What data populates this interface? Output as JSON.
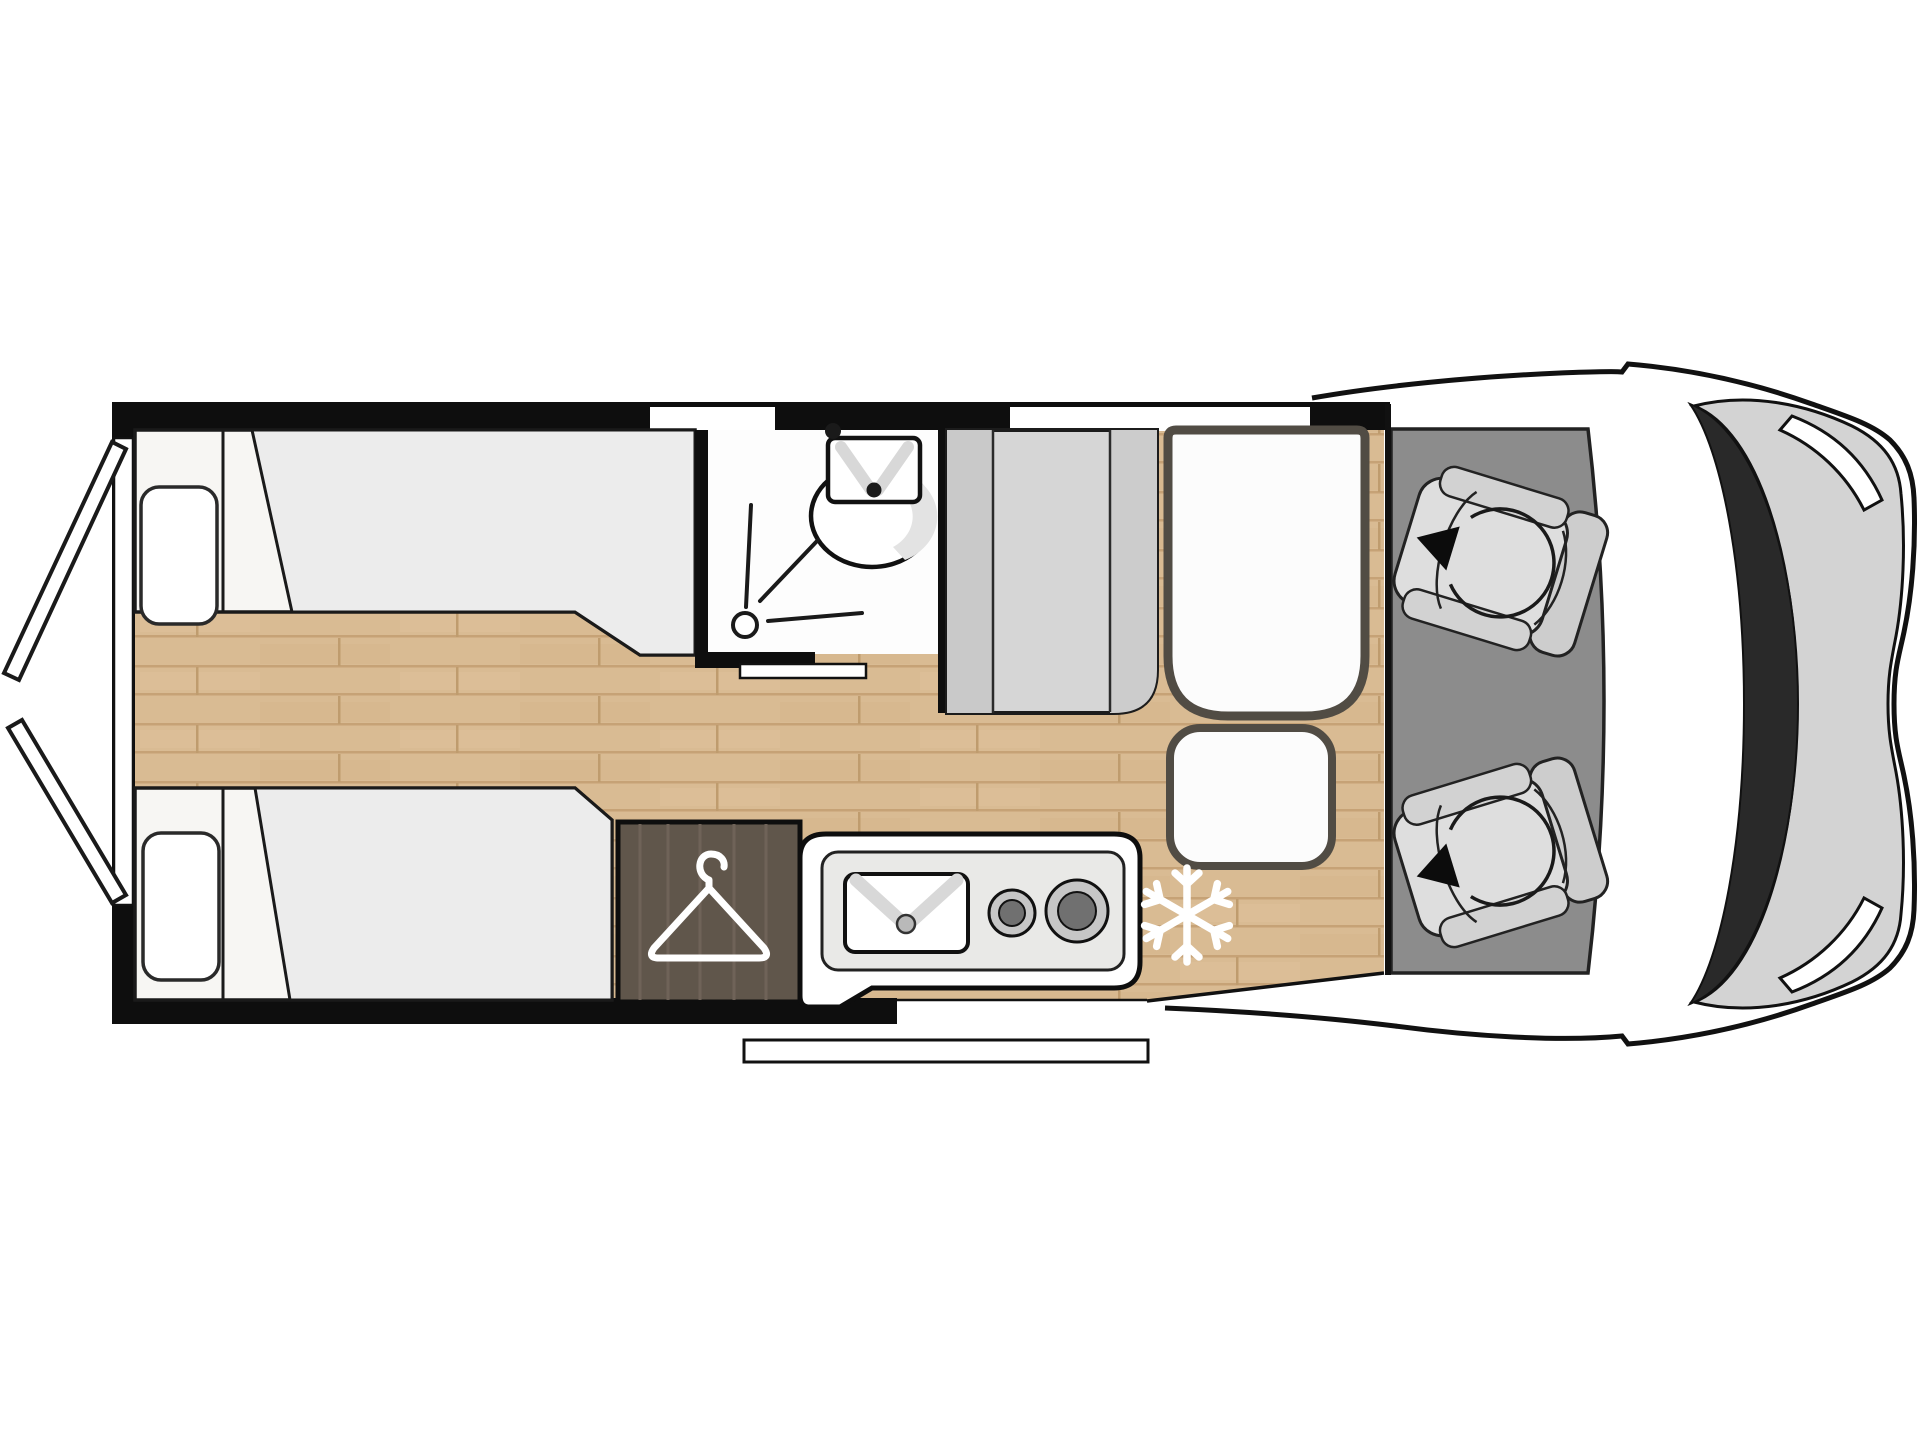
{
  "page": {
    "description": "Top-down floor plan of a campervan / motorhome with rear twin single beds, wardrobe, bathroom, kitchen and swivel cab seats",
    "view": "top-down floor plan",
    "visible_text": []
  },
  "diagram": {
    "type": "floor-plan",
    "vehicle": "campervan",
    "features": {
      "rear_doors": {
        "label": "Rear doors shown open",
        "count": 2
      },
      "bed_top": {
        "label": "Rear single bed with pillow (left side)"
      },
      "bed_bottom": {
        "label": "Rear single bed with pillow (right side)"
      },
      "corridor": {
        "label": "Central wood-floor corridor between beds"
      },
      "wardrobe": {
        "label": "Wardrobe",
        "icon": "hanger-icon"
      },
      "bathroom": {
        "label": "Bathroom with shower and washbasin",
        "icons": [
          "shower-drain-icon",
          "washbasin-icon"
        ]
      },
      "bathroom_door": {
        "label": "Sliding bathroom door"
      },
      "kitchen": {
        "label": "Kitchen unit with sink and two-burner hob",
        "burners": 2
      },
      "fridge": {
        "label": "Refrigerator position",
        "icon": "snowflake-icon"
      },
      "cabinet": {
        "label": "Tall cabinet / sideboard unit"
      },
      "dinette_bench": {
        "label": "Dinette bench seat"
      },
      "dinette_seat": {
        "label": "Dinette seat extension"
      },
      "entry_step": {
        "label": "Entrance step at sliding-door opening"
      },
      "cab": {
        "label": "Driver cab with two swivelling seats",
        "seats": 2,
        "icon": "swivel-arrow-icon"
      },
      "windshield": {
        "label": "Windshield"
      },
      "headlights": {
        "label": "Headlights",
        "count": 2
      },
      "windows": {
        "label": "Side windows in top wall",
        "count": 2
      }
    },
    "colors": {
      "wall": "#0e0e0e",
      "floor_wood": "#d9bb93",
      "floor_wood_line": "#c6a276",
      "mattress": "#ececec",
      "bed_base": "#f7f6f3",
      "cab_floor": "#8c8c8c",
      "cabinet_gray": "#d6d6d6",
      "wardrobe_wood": "#60564b",
      "seat_trim": "#514c44",
      "windshield": "#292929",
      "hood": "#d3d3d3",
      "icon_white": "#ffffff",
      "outline": "#111111"
    }
  }
}
